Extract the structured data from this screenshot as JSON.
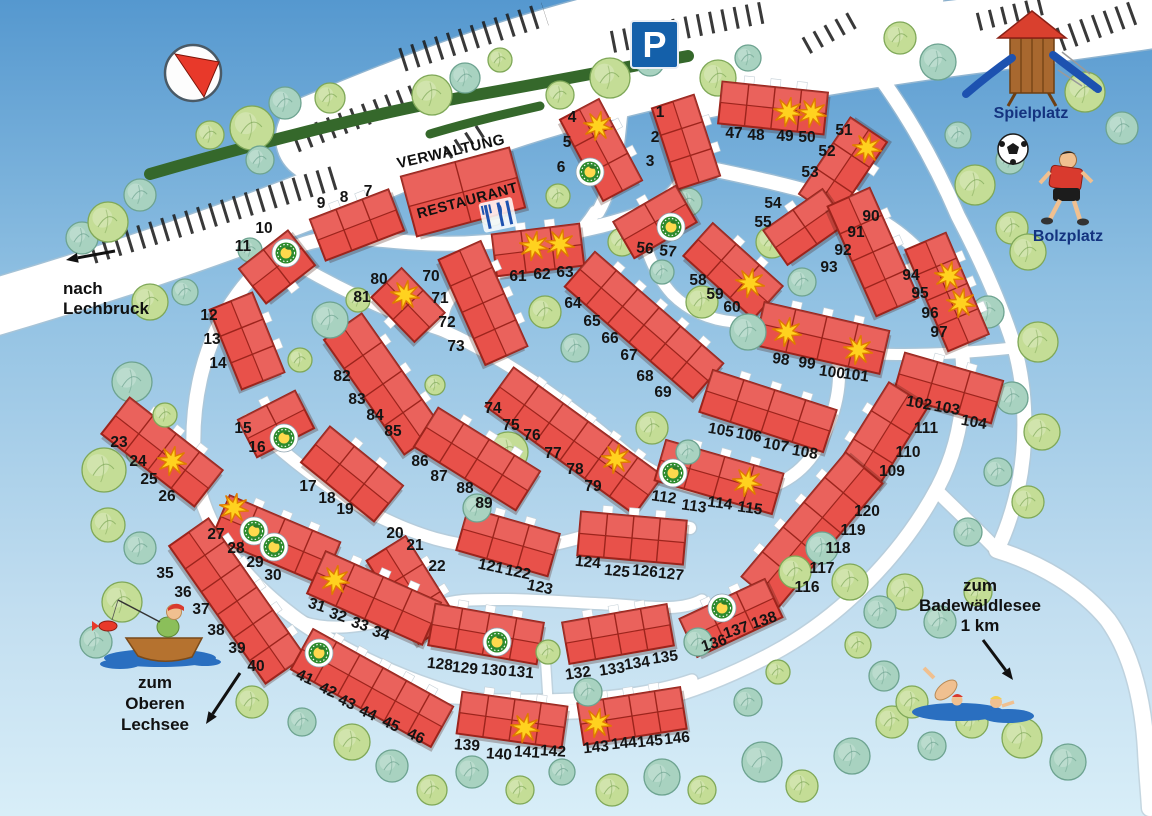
{
  "map": {
    "width": 1152,
    "height": 816
  },
  "colors": {
    "sky_top": "#5598cf",
    "sky_mid": "#8fc0e2",
    "sky_bottom": "#d8eef8",
    "road": "#ffffff",
    "road_edge": "#b7c4ce",
    "building": "#e8514a",
    "building_outline": "#9c241c",
    "tree_green_fill": "#c4dd96",
    "tree_green_edge": "#7fa858",
    "tree_teal_fill": "#a8d2c0",
    "tree_teal_edge": "#6da390",
    "hedge": "#35682b",
    "stripe": "#1e1e1e",
    "star_fill": "#ffd21f",
    "star_edge": "#e07b00",
    "badge_ring": "#2e8b2e",
    "badge_center": "#ffd94d",
    "water": "#2a6fc0",
    "sign_blue": "#1460aa",
    "number_label": "#141414",
    "place_label": "#14337f",
    "compass_red": "#e8392a",
    "playground_roof": "#d9402e",
    "playground_wood": "#a8682f",
    "slide_blue": "#1d52b0",
    "shirt_red": "#d93a2e",
    "skin": "#f0c090",
    "boat_brown": "#b5722f"
  },
  "landmarks": {
    "parking_sign": "P",
    "verwaltung": "VERWALTUNG",
    "restaurant": "RESTAURANT",
    "spielplatz": "Spielplatz",
    "bolzplatz": "Bolzplatz",
    "nach_lechbruck": [
      "nach",
      "Lechbruck"
    ],
    "zum_oberen_lechsee": [
      "zum",
      "Oberen",
      "Lechsee"
    ],
    "zum_badewaeldlesee": [
      "zum",
      "Badewäldlesee",
      "1 km"
    ],
    "icons": [
      "compass-icon",
      "parking-sign",
      "restaurant-utensils-icon",
      "playground-icon",
      "soccer-ball-icon",
      "soccer-player-icon",
      "fisherman-boat-icon",
      "swimmers-icon",
      "star-icon",
      "resort-badge-icon"
    ]
  },
  "stars": [
    [
      598,
      126
    ],
    [
      534,
      246
    ],
    [
      560,
      244
    ],
    [
      788,
      112
    ],
    [
      812,
      113
    ],
    [
      867,
      148
    ],
    [
      750,
      283
    ],
    [
      616,
      459
    ],
    [
      405,
      295
    ],
    [
      172,
      461
    ],
    [
      234,
      508
    ],
    [
      335,
      580
    ],
    [
      949,
      276
    ],
    [
      961,
      303
    ],
    [
      787,
      332
    ],
    [
      858,
      350
    ],
    [
      747,
      482
    ],
    [
      525,
      728
    ],
    [
      597,
      723
    ]
  ],
  "badges": [
    [
      286,
      253
    ],
    [
      590,
      172
    ],
    [
      671,
      227
    ],
    [
      284,
      438
    ],
    [
      254,
      531
    ],
    [
      274,
      547
    ],
    [
      319,
      653
    ],
    [
      673,
      473
    ],
    [
      497,
      642
    ],
    [
      722,
      608
    ]
  ],
  "buildings": [
    {
      "u": [
        "1",
        "2",
        "3"
      ],
      "c": [
        686,
        142
      ],
      "s": [
        85,
        44
      ],
      "r": 72,
      "st": -1,
      "lr": 0,
      "lp": [
        [
          660,
          112
        ],
        [
          655,
          137
        ],
        [
          650,
          161
        ]
      ]
    },
    {
      "u": [
        "4",
        "5",
        "6"
      ],
      "c": [
        601,
        150
      ],
      "s": [
        92,
        44
      ],
      "r": 62,
      "st": -1,
      "lr": 0,
      "lp": [
        [
          572,
          117
        ],
        [
          567,
          142
        ],
        [
          561,
          167
        ]
      ]
    },
    {
      "u": [
        "9",
        "8",
        "7"
      ],
      "c": [
        357,
        225
      ],
      "s": [
        84,
        44
      ],
      "r": -21,
      "st": -1,
      "lr": 0,
      "lp": [
        [
          321,
          203
        ],
        [
          344,
          197
        ],
        [
          368,
          191
        ]
      ]
    },
    {
      "u": [
        "11",
        "10"
      ],
      "c": [
        277,
        267
      ],
      "s": [
        62,
        44
      ],
      "r": -38,
      "st": 1,
      "lr": 0,
      "lp": [
        [
          243,
          246
        ],
        [
          264,
          228
        ]
      ]
    },
    {
      "u": [
        "12",
        "13",
        "14"
      ],
      "c": [
        247,
        341
      ],
      "s": [
        86,
        46
      ],
      "r": 68,
      "st": -1,
      "lr": 0,
      "lp": [
        [
          209,
          315
        ],
        [
          212,
          339
        ],
        [
          218,
          363
        ]
      ]
    },
    {
      "u": [
        "15",
        "16"
      ],
      "c": [
        276,
        424
      ],
      "s": [
        64,
        42
      ],
      "r": -27,
      "st": -1,
      "lr": 0,
      "lp": [
        [
          243,
          428
        ],
        [
          257,
          447
        ]
      ]
    },
    {
      "u": [
        "17",
        "18",
        "19"
      ],
      "c": [
        352,
        474
      ],
      "s": [
        94,
        46
      ],
      "r": 39,
      "st": -1,
      "lr": 0,
      "lp": [
        [
          308,
          486
        ],
        [
          327,
          498
        ],
        [
          345,
          509
        ]
      ]
    },
    {
      "u": [
        "20",
        "21",
        "22"
      ],
      "c": [
        412,
        590
      ],
      "s": [
        98,
        46
      ],
      "r": 58,
      "st": -1,
      "lr": 0,
      "lp": [
        [
          395,
          533
        ],
        [
          415,
          545
        ],
        [
          437,
          566
        ]
      ]
    },
    {
      "u": [
        "23",
        "24",
        "25",
        "26"
      ],
      "c": [
        162,
        452
      ],
      "s": [
        118,
        46
      ],
      "r": 38,
      "st": -1,
      "lr": 0,
      "lp": [
        [
          119,
          442
        ],
        [
          138,
          461
        ],
        [
          149,
          479
        ],
        [
          167,
          496
        ]
      ]
    },
    {
      "u": [
        "27",
        "28",
        "29",
        "30"
      ],
      "c": [
        276,
        540
      ],
      "s": [
        120,
        46
      ],
      "r": 23,
      "st": -1,
      "lr": 0,
      "lp": [
        [
          216,
          534
        ],
        [
          236,
          548
        ],
        [
          255,
          562
        ],
        [
          273,
          575
        ]
      ]
    },
    {
      "u": [
        "31",
        "32",
        "33",
        "34"
      ],
      "c": [
        374,
        598
      ],
      "s": [
        126,
        46
      ],
      "r": 24,
      "st": -1,
      "lr": 18,
      "lp": [
        [
          317,
          605
        ],
        [
          338,
          615
        ],
        [
          360,
          624
        ],
        [
          381,
          633
        ]
      ]
    },
    {
      "u": [
        "35",
        "36",
        "37",
        "38",
        "39",
        "40"
      ],
      "c": [
        237,
        601
      ],
      "s": [
        168,
        48
      ],
      "r": 55,
      "st": -1,
      "lr": 0,
      "lp": [
        [
          165,
          573
        ],
        [
          183,
          592
        ],
        [
          201,
          609
        ],
        [
          216,
          630
        ],
        [
          237,
          648
        ],
        [
          256,
          666
        ]
      ]
    },
    {
      "u": [
        "41",
        "42",
        "43",
        "44",
        "45",
        "46"
      ],
      "c": [
        372,
        688
      ],
      "s": [
        160,
        46
      ],
      "r": 29,
      "st": -1,
      "lr": 24,
      "lp": [
        [
          305,
          677
        ],
        [
          328,
          690
        ],
        [
          347,
          702
        ],
        [
          368,
          713
        ],
        [
          391,
          724
        ],
        [
          416,
          736
        ]
      ]
    },
    {
      "u": [
        "47",
        "48",
        "49",
        "50"
      ],
      "c": [
        773,
        108
      ],
      "s": [
        106,
        42
      ],
      "r": 6,
      "st": -1,
      "lr": 0,
      "lp": [
        [
          734,
          133
        ],
        [
          756,
          135
        ],
        [
          785,
          136
        ],
        [
          807,
          137
        ]
      ]
    },
    {
      "u": [
        "51",
        "52",
        "53"
      ],
      "c": [
        843,
        168
      ],
      "s": [
        92,
        44
      ],
      "r": -56,
      "st": 1,
      "lr": 0,
      "lp": [
        [
          844,
          130
        ],
        [
          827,
          151
        ],
        [
          810,
          172
        ]
      ]
    },
    {
      "u": [
        "54",
        "55"
      ],
      "c": [
        805,
        227
      ],
      "s": [
        72,
        42
      ],
      "r": -35,
      "st": -1,
      "lr": 0,
      "lp": [
        [
          773,
          203
        ],
        [
          763,
          222
        ]
      ]
    },
    {
      "u": [
        "56",
        "57"
      ],
      "c": [
        655,
        222
      ],
      "s": [
        72,
        42
      ],
      "r": -30,
      "st": -1,
      "lr": 6,
      "lp": [
        [
          645,
          248
        ],
        [
          668,
          251
        ]
      ]
    },
    {
      "u": [
        "58",
        "59",
        "60"
      ],
      "c": [
        733,
        271
      ],
      "s": [
        94,
        44
      ],
      "r": 42,
      "st": -1,
      "lr": 0,
      "lp": [
        [
          698,
          280
        ],
        [
          715,
          294
        ],
        [
          732,
          307
        ]
      ]
    },
    {
      "u": [
        "61",
        "62",
        "63"
      ],
      "c": [
        538,
        250
      ],
      "s": [
        88,
        42
      ],
      "r": -7,
      "st": -1,
      "lr": 0,
      "lp": [
        [
          518,
          276
        ],
        [
          542,
          274
        ],
        [
          565,
          272
        ]
      ]
    },
    {
      "u": [
        "64",
        "65",
        "66",
        "67",
        "68",
        "69"
      ],
      "c": [
        644,
        325
      ],
      "s": [
        170,
        46
      ],
      "r": 41,
      "st": -1,
      "lr": 0,
      "lp": [
        [
          573,
          303
        ],
        [
          592,
          321
        ],
        [
          610,
          338
        ],
        [
          629,
          355
        ],
        [
          645,
          376
        ],
        [
          663,
          392
        ]
      ]
    },
    {
      "u": [
        "70",
        "71",
        "72",
        "73"
      ],
      "c": [
        483,
        303
      ],
      "s": [
        115,
        46
      ],
      "r": 66,
      "st": -1,
      "lr": 0,
      "lp": [
        [
          431,
          276
        ],
        [
          440,
          298
        ],
        [
          447,
          322
        ],
        [
          456,
          346
        ]
      ]
    },
    {
      "u": [
        "74",
        "75",
        "76",
        "77",
        "78",
        "79"
      ],
      "c": [
        574,
        441
      ],
      "s": [
        184,
        48
      ],
      "r": 36,
      "st": -1,
      "lr": 0,
      "lp": [
        [
          493,
          408
        ],
        [
          511,
          425
        ],
        [
          532,
          435
        ],
        [
          553,
          453
        ],
        [
          575,
          469
        ],
        [
          593,
          486
        ]
      ]
    },
    {
      "u": [
        "80",
        "81"
      ],
      "c": [
        408,
        305
      ],
      "s": [
        62,
        42
      ],
      "r": 46,
      "st": 1,
      "lr": 0,
      "lp": [
        [
          379,
          279
        ],
        [
          362,
          297
        ]
      ]
    },
    {
      "u": [
        "82",
        "83",
        "84",
        "85"
      ],
      "c": [
        383,
        384
      ],
      "s": [
        140,
        46
      ],
      "r": 55,
      "st": -1,
      "lr": 0,
      "lp": [
        [
          342,
          376
        ],
        [
          357,
          399
        ],
        [
          375,
          415
        ],
        [
          393,
          431
        ]
      ]
    },
    {
      "u": [
        "86",
        "87",
        "88",
        "89"
      ],
      "c": [
        477,
        459
      ],
      "s": [
        120,
        46
      ],
      "r": 32,
      "st": -1,
      "lr": 0,
      "lp": [
        [
          420,
          461
        ],
        [
          439,
          476
        ],
        [
          465,
          488
        ],
        [
          484,
          503
        ]
      ]
    },
    {
      "u": [
        "90",
        "91",
        "92",
        "93"
      ],
      "c": [
        873,
        252
      ],
      "s": [
        120,
        46
      ],
      "r": 66,
      "st": -1,
      "lr": 0,
      "lp": [
        [
          871,
          216
        ],
        [
          856,
          232
        ],
        [
          843,
          250
        ],
        [
          829,
          267
        ]
      ]
    },
    {
      "u": [
        "94",
        "95",
        "96",
        "97"
      ],
      "c": [
        947,
        292
      ],
      "s": [
        110,
        44
      ],
      "r": 67,
      "st": -1,
      "lr": 0,
      "lp": [
        [
          911,
          275
        ],
        [
          920,
          293
        ],
        [
          930,
          313
        ],
        [
          939,
          332
        ]
      ]
    },
    {
      "u": [
        "98",
        "99",
        "100",
        "101"
      ],
      "c": [
        822,
        338
      ],
      "s": [
        128,
        44
      ],
      "r": 13,
      "st": -1,
      "lr": 8,
      "lp": [
        [
          781,
          359
        ],
        [
          807,
          363
        ],
        [
          832,
          372
        ],
        [
          856,
          375
        ]
      ]
    },
    {
      "u": [
        "102",
        "103",
        "104"
      ],
      "c": [
        948,
        388
      ],
      "s": [
        102,
        44
      ],
      "r": 16,
      "st": -1,
      "lr": 10,
      "lp": [
        [
          919,
          403
        ],
        [
          947,
          408
        ],
        [
          974,
          422
        ]
      ]
    },
    {
      "u": [
        "105",
        "106",
        "107",
        "108"
      ],
      "c": [
        768,
        411
      ],
      "s": [
        130,
        44
      ],
      "r": 18,
      "st": -1,
      "lr": 10,
      "lp": [
        [
          721,
          430
        ],
        [
          749,
          435
        ],
        [
          776,
          445
        ],
        [
          805,
          452
        ]
      ]
    },
    {
      "u": [
        "109",
        "110",
        "111"
      ],
      "c": [
        882,
        437
      ],
      "s": [
        100,
        46
      ],
      "r": -58,
      "st": -1,
      "lr": 0,
      "lp": [
        [
          892,
          471
        ],
        [
          908,
          452
        ],
        [
          926,
          428
        ]
      ]
    },
    {
      "u": [
        "112",
        "113",
        "114",
        "115"
      ],
      "c": [
        719,
        477
      ],
      "s": [
        122,
        42
      ],
      "r": 16,
      "st": -1,
      "lr": 8,
      "lp": [
        [
          664,
          497
        ],
        [
          694,
          506
        ],
        [
          720,
          503
        ],
        [
          750,
          508
        ]
      ]
    },
    {
      "u": [
        "116",
        "117",
        "118",
        "119",
        "120"
      ],
      "c": [
        812,
        530
      ],
      "s": [
        162,
        48
      ],
      "r": -50,
      "st": -1,
      "lr": 0,
      "lp": [
        [
          807,
          587
        ],
        [
          822,
          568
        ],
        [
          838,
          548
        ],
        [
          853,
          530
        ],
        [
          867,
          511
        ]
      ]
    },
    {
      "u": [
        "121",
        "122",
        "123"
      ],
      "c": [
        508,
        542
      ],
      "s": [
        95,
        44
      ],
      "r": 16,
      "st": -1,
      "lr": 12,
      "lp": [
        [
          491,
          566
        ],
        [
          518,
          572
        ],
        [
          540,
          587
        ]
      ]
    },
    {
      "u": [
        "124",
        "125",
        "126",
        "127"
      ],
      "c": [
        632,
        538
      ],
      "s": [
        106,
        44
      ],
      "r": 5,
      "st": -1,
      "lr": 6,
      "lp": [
        [
          588,
          562
        ],
        [
          617,
          571
        ],
        [
          645,
          571
        ],
        [
          671,
          574
        ]
      ]
    },
    {
      "u": [
        "128",
        "129",
        "130",
        "131"
      ],
      "c": [
        486,
        634
      ],
      "s": [
        110,
        42
      ],
      "r": 10,
      "st": -1,
      "lr": 6,
      "lp": [
        [
          440,
          664
        ],
        [
          465,
          668
        ],
        [
          494,
          670
        ],
        [
          521,
          672
        ]
      ]
    },
    {
      "u": [
        "132",
        "133",
        "134",
        "135"
      ],
      "c": [
        618,
        634
      ],
      "s": [
        106,
        42
      ],
      "r": -10,
      "st": -1,
      "lr": -8,
      "lp": [
        [
          578,
          673
        ],
        [
          612,
          669
        ],
        [
          637,
          663
        ],
        [
          665,
          657
        ]
      ]
    },
    {
      "u": [
        "136",
        "137",
        "138"
      ],
      "c": [
        731,
        618
      ],
      "s": [
        94,
        42
      ],
      "r": -25,
      "st": -1,
      "lr": -18,
      "lp": [
        [
          714,
          643
        ],
        [
          736,
          630
        ],
        [
          764,
          620
        ]
      ]
    },
    {
      "u": [
        "139",
        "140",
        "141",
        "142"
      ],
      "c": [
        512,
        720
      ],
      "s": [
        106,
        42
      ],
      "r": 8,
      "st": -1,
      "lr": 4,
      "lp": [
        [
          467,
          745
        ],
        [
          499,
          754
        ],
        [
          527,
          752
        ],
        [
          553,
          751
        ]
      ]
    },
    {
      "u": [
        "143",
        "144",
        "145",
        "146"
      ],
      "c": [
        632,
        716
      ],
      "s": [
        104,
        42
      ],
      "r": -9,
      "st": -1,
      "lr": -6,
      "lp": [
        [
          596,
          747
        ],
        [
          624,
          743
        ],
        [
          650,
          741
        ],
        [
          677,
          738
        ]
      ]
    }
  ],
  "restaurant_building": {
    "c": [
      463,
      192
    ],
    "s": [
      112,
      62
    ],
    "r": -15
  }
}
